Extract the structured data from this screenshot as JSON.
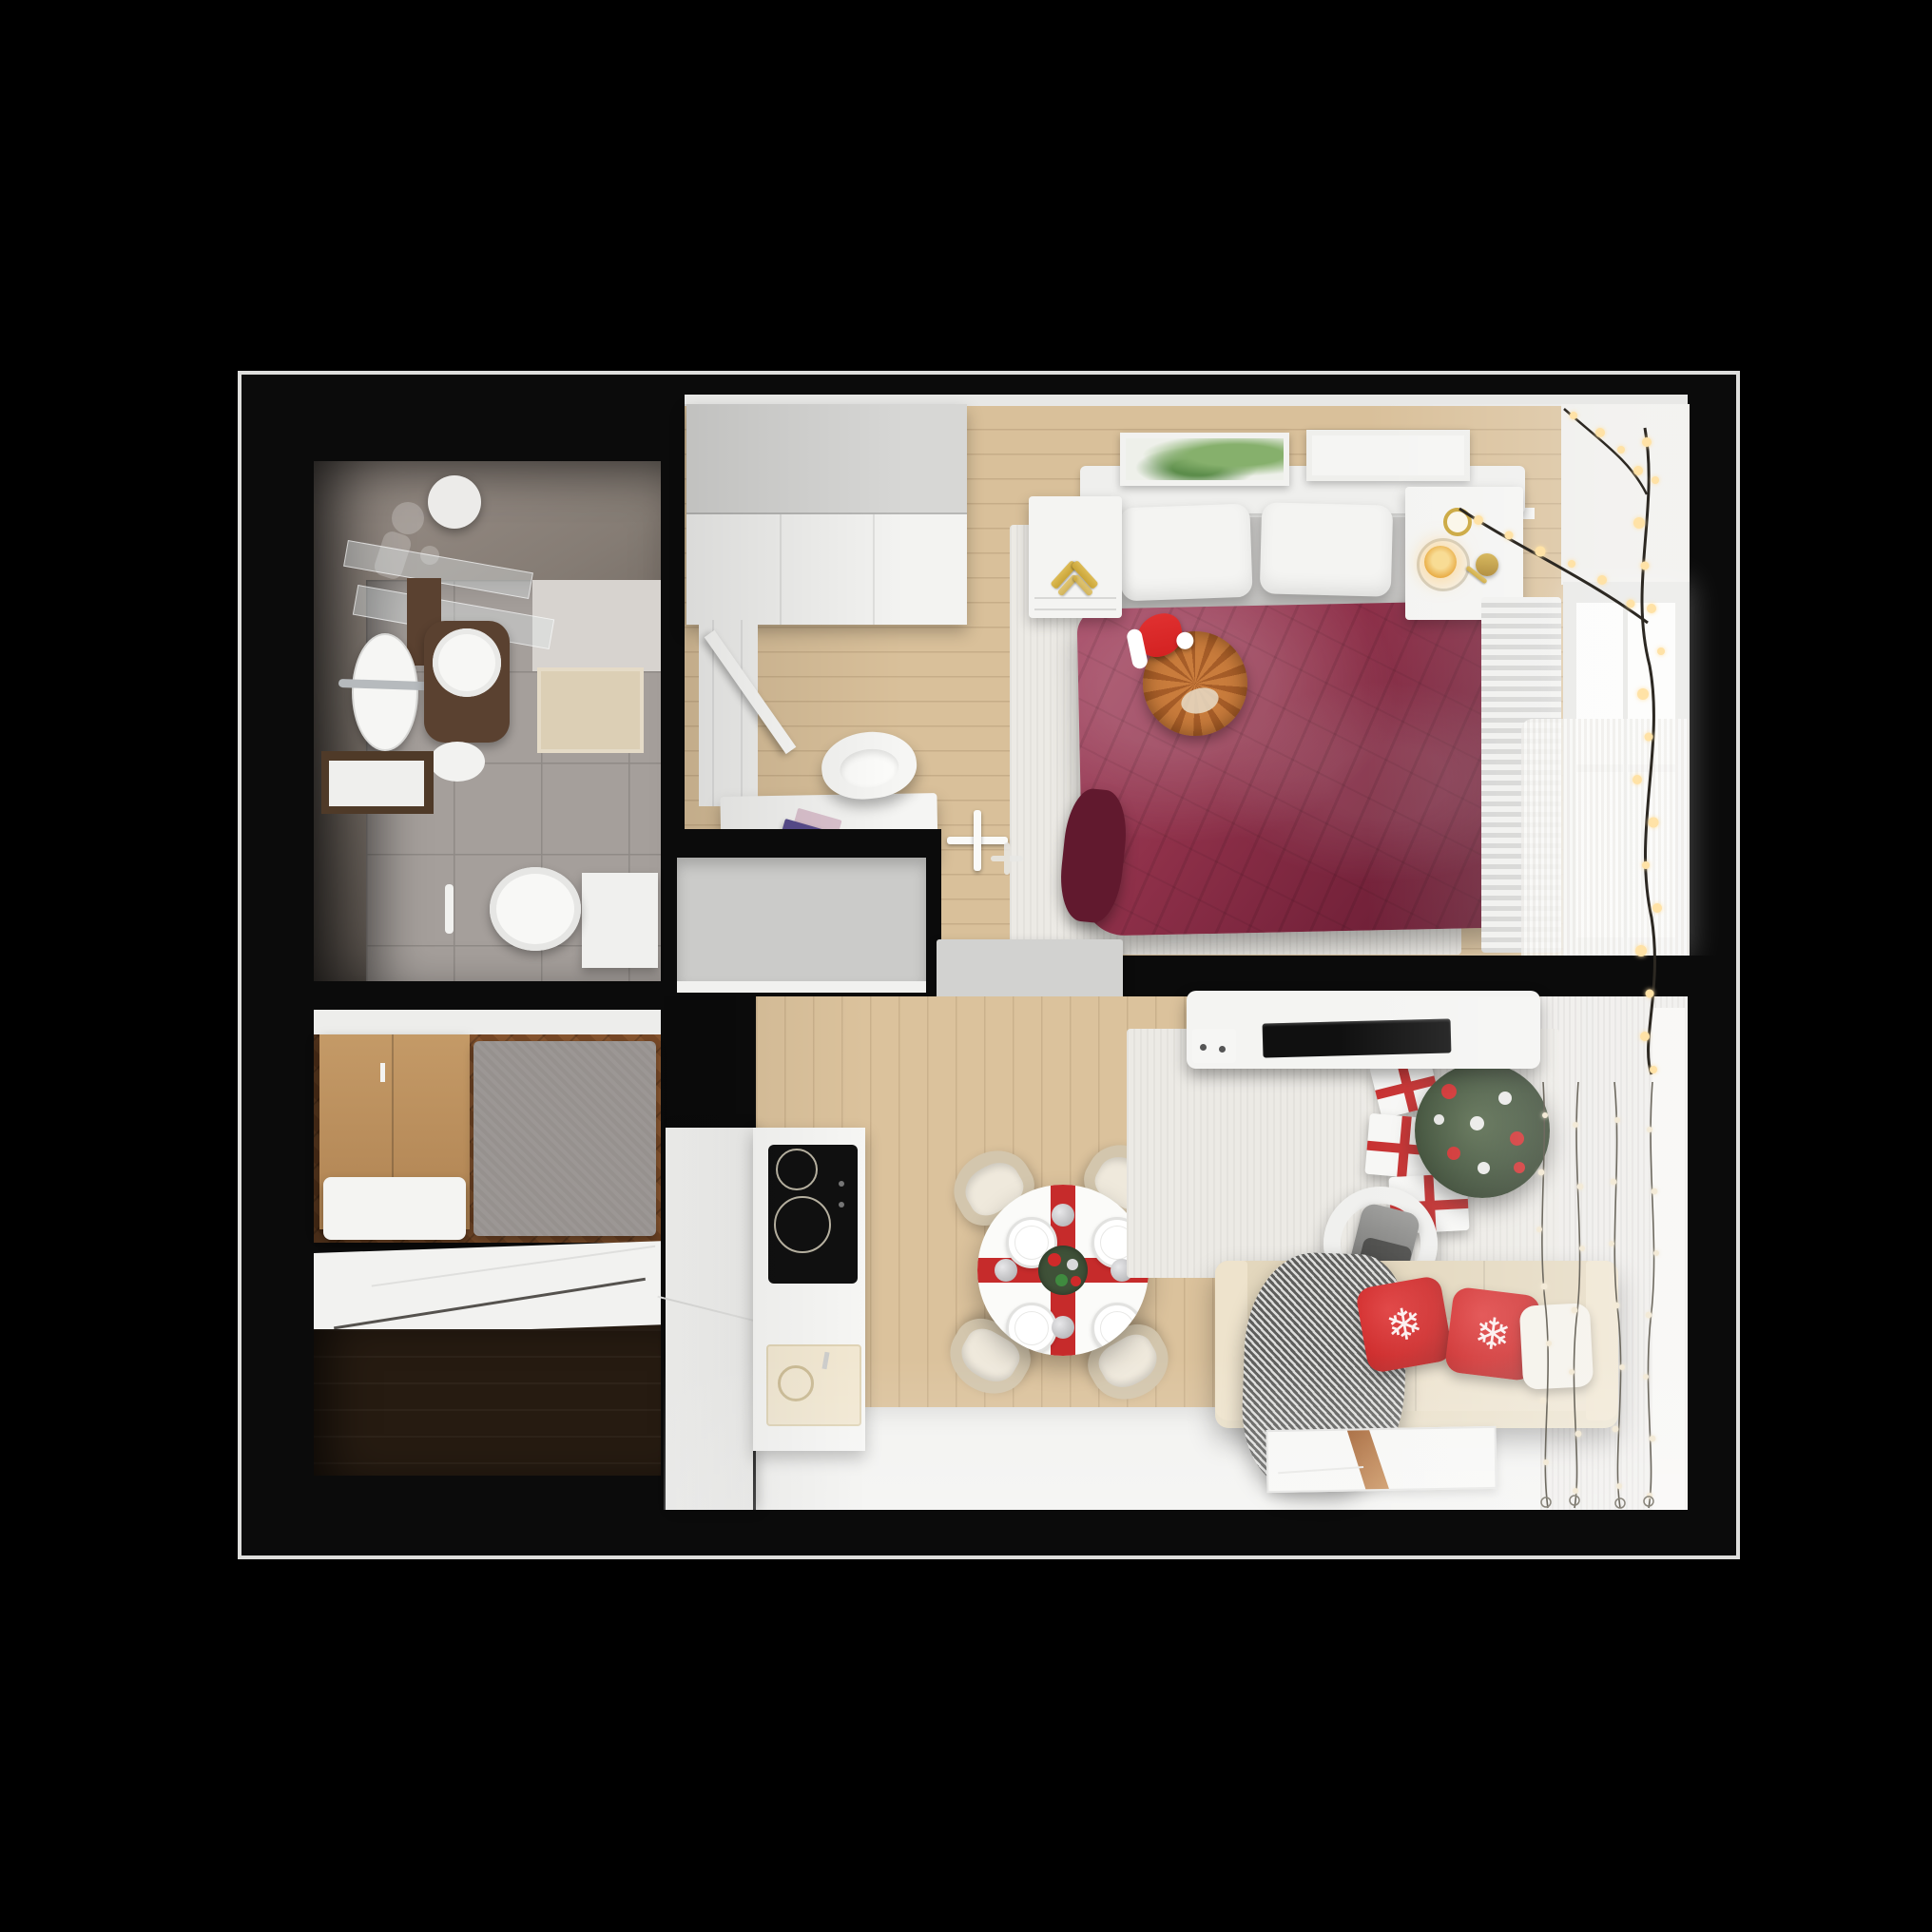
{
  "scene": {
    "title": "Top-down 3D render of a one-bedroom apartment decorated for Christmas",
    "view": "floor-plan bird's eye",
    "label": "apartment-render"
  },
  "palette": {
    "bg": "#000000",
    "wall": "#0b0b0b",
    "outline": "#dededc",
    "stoneA": "#9a9089",
    "stoneD": "#4a443f",
    "tile": "#a59f9b",
    "tileLine": "#8f8a86",
    "lightWall": "#d7d3cf",
    "mat": "#dccfb5",
    "woodDark": "#5a4130",
    "woodMid": "#8a5730",
    "woodHall2": "#7a4a27",
    "storageDark": "#261b11",
    "oakBed": "#d9c09a",
    "oakLiving": "#dbc29c",
    "white": "#f4f4f2",
    "white2": "#ececea",
    "greyPanel": "#d7d7d5",
    "greyCab": "#cbcbc9",
    "sheet": "#c9c8c6",
    "rugLight": "#eceae5",
    "maroon": "#8e3049",
    "maroonHi": "#a34561",
    "maroonLo": "#61192e",
    "cat": "#c97c3c",
    "catStripe": "#a65d28",
    "santaRed": "#d42222",
    "accentRed": "#c62b2b",
    "pillowRed": "#cf2a2a",
    "treeGreen": "#3f5138",
    "treeDark": "#2c3a26",
    "sofa": "#e9dfc8",
    "sofaDark": "#e3d7bd",
    "chairBeige": "#d3c6ad",
    "throwGrey": "#5e5e5c",
    "gold": "#c9a437",
    "candle": "#e8a93c",
    "lightWarm": "#ffe2a6",
    "lightPale": "#f3ead7",
    "floorWhite": "#f2f2f0",
    "curtain": "#edebe8",
    "windowBright": "#fcfcfb",
    "radiator": "#d4d4d2",
    "tvBlack": "#101010"
  },
  "rooms": {
    "bathroom": {
      "label": "Bathroom",
      "items": [
        "vanity sinks",
        "round mirror",
        "glass shelves",
        "toilet",
        "bath mat",
        "wood cabinet"
      ]
    },
    "hallway": {
      "label": "Hallway",
      "items": [
        "wardrobe",
        "grey rug",
        "bench"
      ]
    },
    "storage": {
      "label": "Storage room",
      "items": [
        "dark wood floor",
        "white panels"
      ]
    },
    "bedroom": {
      "label": "Bedroom",
      "items": [
        "white wardrobe",
        "double bed",
        "burgundy blanket",
        "cat with santa hat",
        "two pillows",
        "nightstands",
        "candles",
        "framed pictures",
        "desk with books",
        "shell chair",
        "window",
        "fairy lights",
        "radiator",
        "floor lamp"
      ]
    },
    "living_room": {
      "label": "Living room with kitchen",
      "items": [
        "kitchen counter",
        "induction hob",
        "sink",
        "round dining table",
        "red ribbon runner",
        "four chairs",
        "beige sofa",
        "red snowflake pillows",
        "grey throw",
        "christmas tree",
        "gift boxes",
        "armchair",
        "tv sideboard",
        "window",
        "string light curtain",
        "radiator",
        "floor art rug"
      ]
    }
  },
  "decor": {
    "snowflake_glyph": "❄"
  }
}
